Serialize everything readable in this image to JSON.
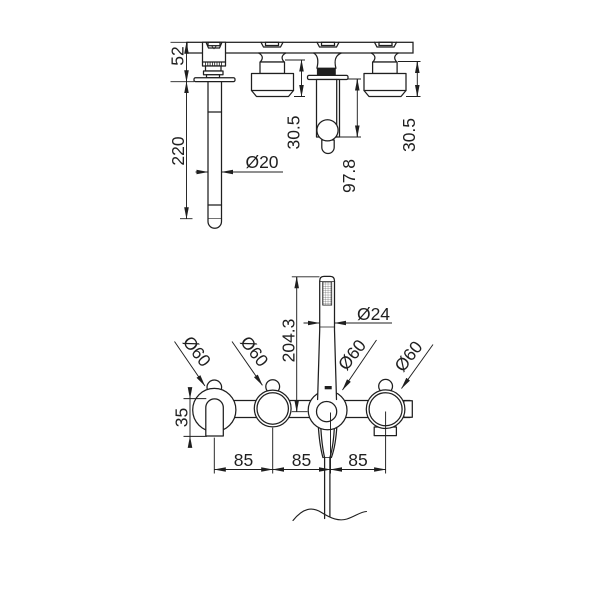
{
  "colors": {
    "line": "#1f1f1f",
    "background": "#ffffff"
  },
  "top_view": {
    "dim_bar_to_wall": "52",
    "dim_spout_length": "220",
    "dim_spout_diameter": "Ø20",
    "dim_left_handle_depth": "30.5",
    "dim_holder_depth": "97.8",
    "dim_right_handle_depth": "30.5"
  },
  "bottom_view": {
    "dim_handshower_height": "204.3",
    "dim_handshower_diameter": "Ø24",
    "dim_rosette_1": "Ø60",
    "dim_rosette_2": "Ø60",
    "dim_rosette_3": "Ø60",
    "dim_rosette_4": "Ø60",
    "dim_spout_drop": "35",
    "dim_spacing_1": "85",
    "dim_spacing_2": "85",
    "dim_spacing_3": "85"
  }
}
